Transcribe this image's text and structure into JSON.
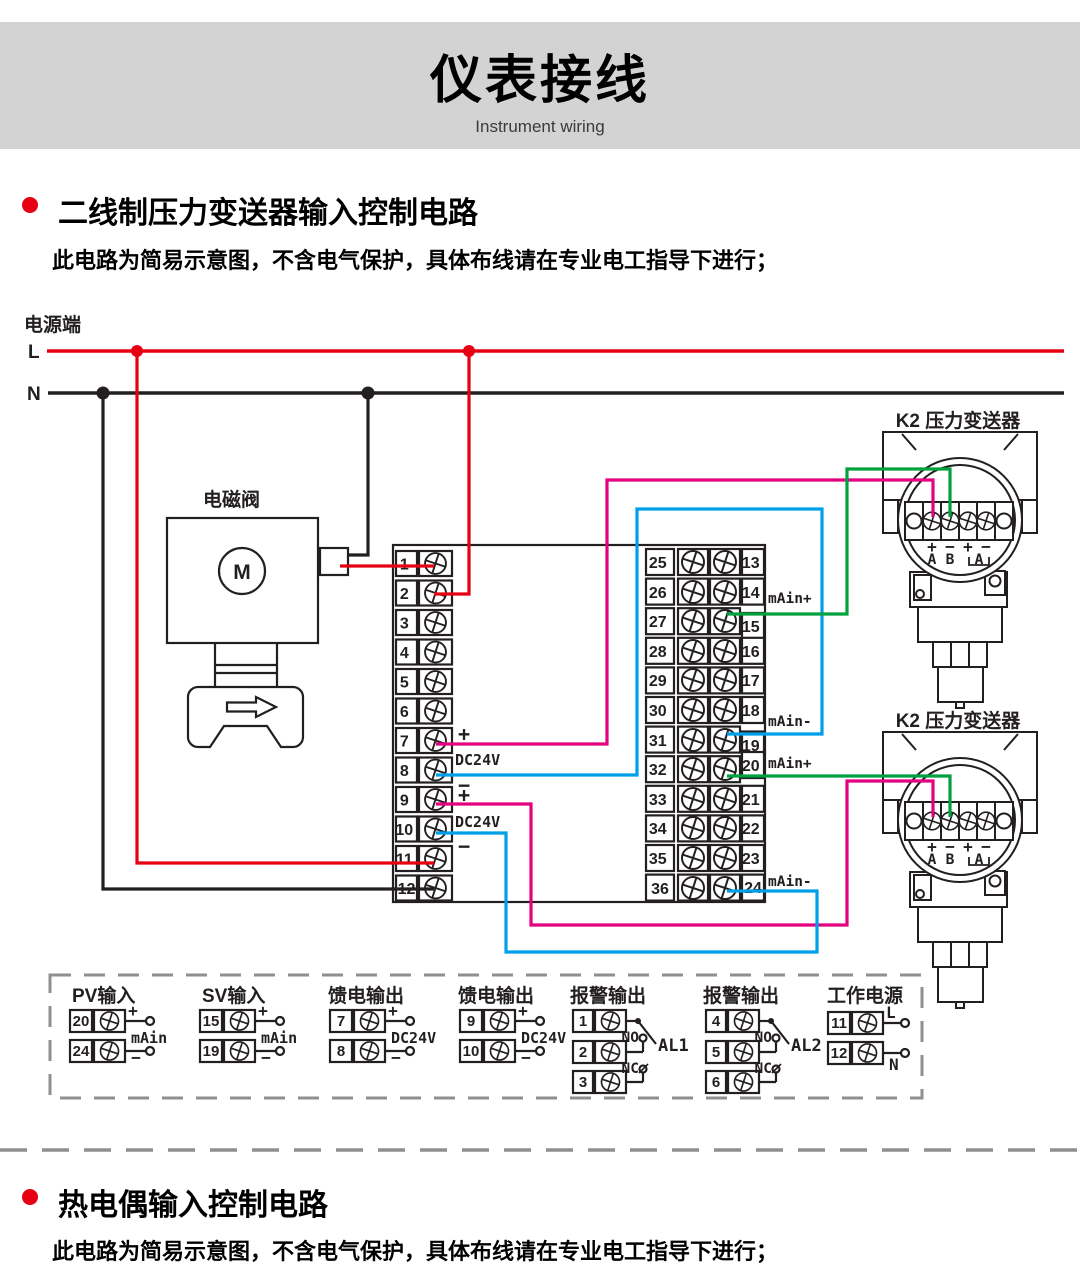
{
  "header": {
    "title": "仪表接线",
    "subtitle": "Instrument wiring"
  },
  "sections": {
    "pressure": {
      "heading": "二线制压力变送器输入控制电路",
      "note": "此电路为简易示意图，不含电气保护，具体布线请在专业电工指导下进行；"
    },
    "thermocouple": {
      "heading": "热电偶输入控制电路",
      "note": "此电路为简易示意图，不含电气保护，具体布线请在专业电工指导下进行；"
    }
  },
  "power": {
    "label": "电源端",
    "l": "L",
    "n": "N"
  },
  "solenoid": {
    "label": "电磁阀",
    "motor": "M"
  },
  "main_unit": {
    "left": [
      "1",
      "2",
      "3",
      "4",
      "5",
      "6",
      "7",
      "8",
      "9",
      "10",
      "11",
      "12"
    ],
    "left_labels": {
      "p1": "+",
      "d1": "DC24V",
      "m1": "−",
      "p2": "+",
      "d2": "DC24V",
      "m2": "−"
    },
    "mid_left": [
      "25",
      "26",
      "27",
      "28",
      "29",
      "30",
      "31",
      "32",
      "33",
      "34",
      "35",
      "36"
    ],
    "mid_right": [
      "13",
      "14",
      "15",
      "16",
      "17",
      "18",
      "19",
      "20",
      "21",
      "22",
      "23",
      "24"
    ],
    "signals": [
      "mAin+",
      "mAin-",
      "mAin+",
      "mAin-"
    ]
  },
  "transmitter": {
    "label": "K2 压力变送器",
    "signs": [
      "+",
      "−",
      "+",
      "−"
    ],
    "pins": [
      "A",
      "B",
      "A"
    ]
  },
  "legend": {
    "groups": [
      {
        "title": "PV输入",
        "t1": "20",
        "t2": "24",
        "plus": "+",
        "mid": "mAin",
        "minus": "−"
      },
      {
        "title": "SV输入",
        "t1": "15",
        "t2": "19",
        "plus": "+",
        "mid": "mAin",
        "minus": "−"
      },
      {
        "title": "馈电输出",
        "t1": "7",
        "t2": "8",
        "plus": "+",
        "mid": "DC24V",
        "minus": "−"
      },
      {
        "title": "馈电输出",
        "t1": "9",
        "t2": "10",
        "plus": "+",
        "mid": "DC24V",
        "minus": "−"
      },
      {
        "title": "报警输出",
        "t1": "1",
        "t2": "2",
        "t3": "3",
        "no": "NO",
        "nc": "NC",
        "name": "AL1"
      },
      {
        "title": "报警输出",
        "t1": "4",
        "t2": "5",
        "t3": "6",
        "no": "NO",
        "nc": "NC",
        "name": "AL2"
      },
      {
        "title": "工作电源",
        "t1": "11",
        "t2": "12",
        "l": "L",
        "n": "N"
      }
    ]
  },
  "colors": {
    "red": "#e60012",
    "blue": "#00a0e9",
    "green": "#00a13e",
    "magenta": "#e4007f",
    "line": "#231f20",
    "banner_bg": "#d3d3d4",
    "dash_gray": "#8f8f90"
  }
}
